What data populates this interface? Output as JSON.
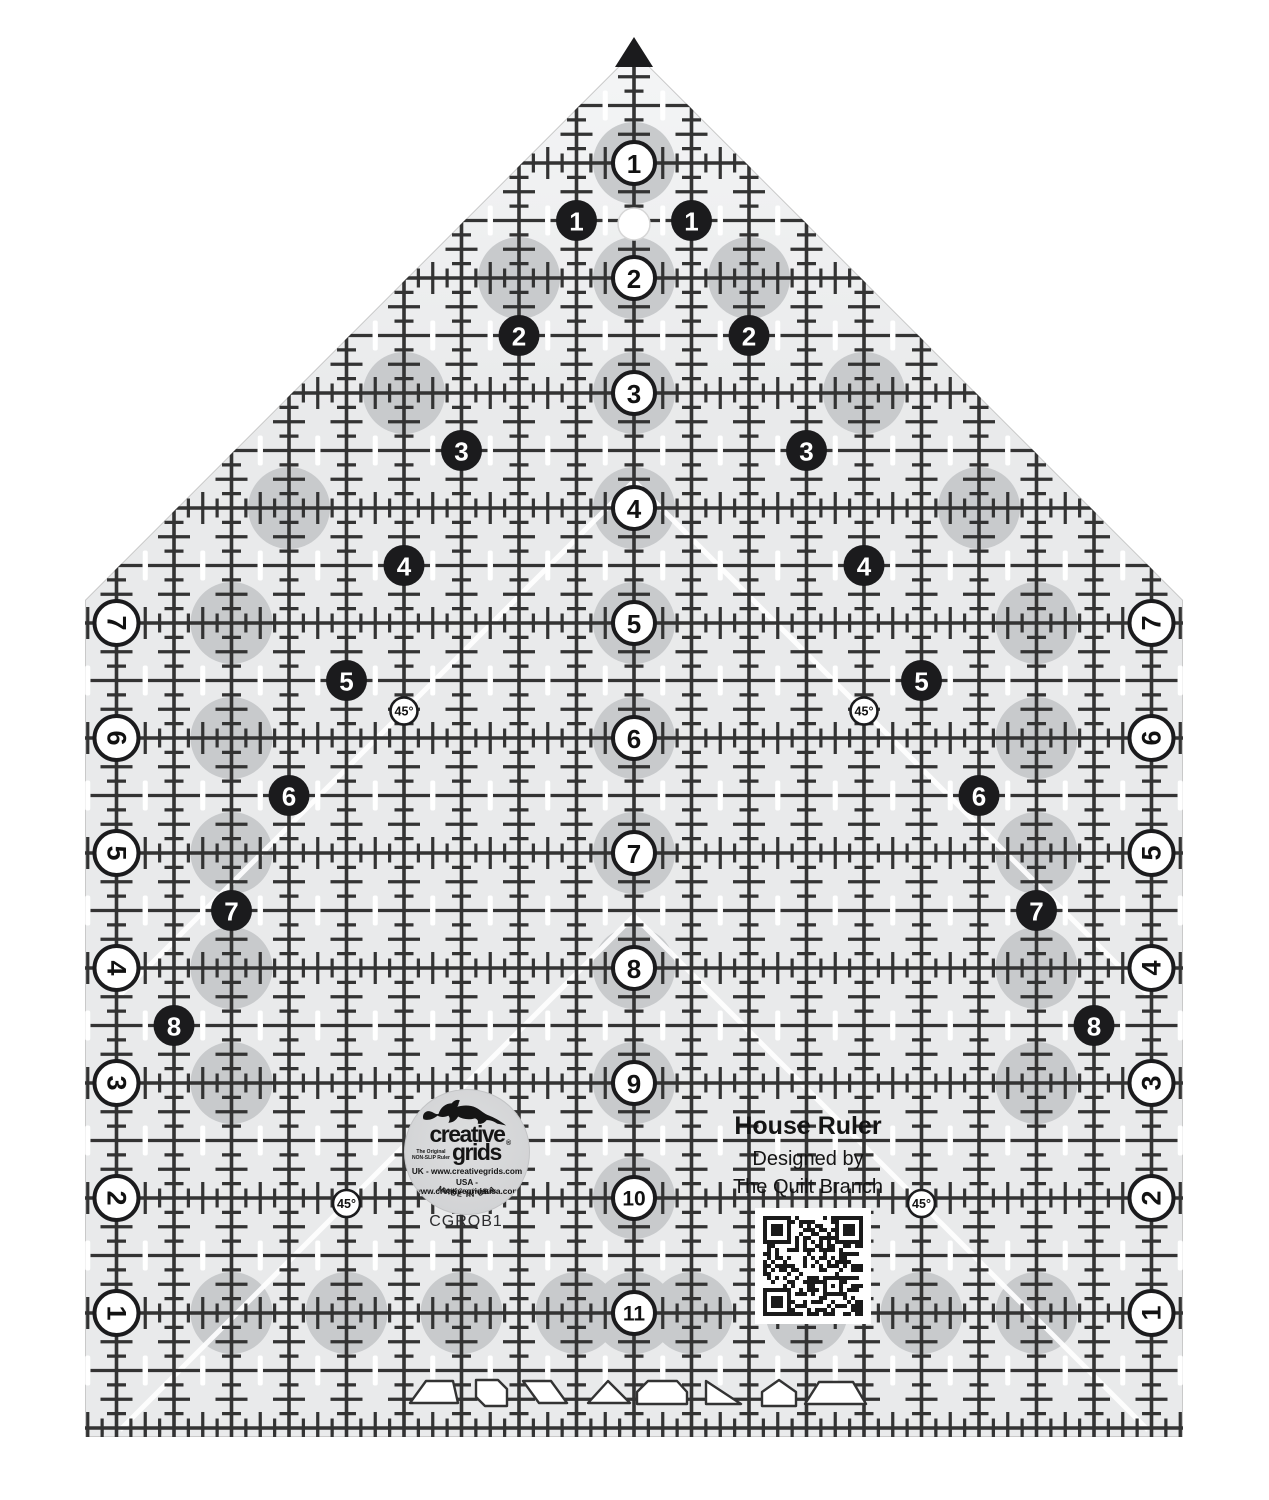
{
  "product": {
    "title": "House Ruler",
    "designed_by": "Designed by",
    "designer": "The Quilt Branch",
    "model": "CGRQB1"
  },
  "logo": {
    "brand_top": "creative",
    "brand_bottom": "grids",
    "registered": "®",
    "tagline": "The Original NON-SLIP Ruler",
    "uk_line": "UK - www.creativegrids.com",
    "usa_line": "USA - www.creativegridsusa.com",
    "copyright": "© 2014 Creative Grids",
    "made_in": "MADE IN USA"
  },
  "ruler": {
    "center_numbers": [
      "1",
      "2",
      "3",
      "4",
      "5",
      "6",
      "7",
      "8",
      "9",
      "10",
      "11"
    ],
    "left_diagonal_numbers": [
      "1",
      "2",
      "3",
      "4",
      "5",
      "6",
      "7",
      "8"
    ],
    "right_diagonal_numbers": [
      "1",
      "2",
      "3",
      "4",
      "5",
      "6",
      "7",
      "8"
    ],
    "left_edge_numbers": [
      "7",
      "6",
      "5",
      "4",
      "3",
      "2",
      "1"
    ],
    "right_edge_numbers": [
      "7",
      "6",
      "5",
      "4",
      "3",
      "2",
      "1"
    ],
    "angle_labels": [
      "45°",
      "45°",
      "45°",
      "45°"
    ]
  },
  "colors": {
    "body": "#e9eaeb",
    "body_light": "#f4f5f6",
    "line": "#333333",
    "grip": "#c8cacc",
    "black_circle": "#1b1b1d",
    "white": "#ffffff",
    "qr_dark": "#1a1a1a",
    "edge": "#c9c9c9"
  }
}
